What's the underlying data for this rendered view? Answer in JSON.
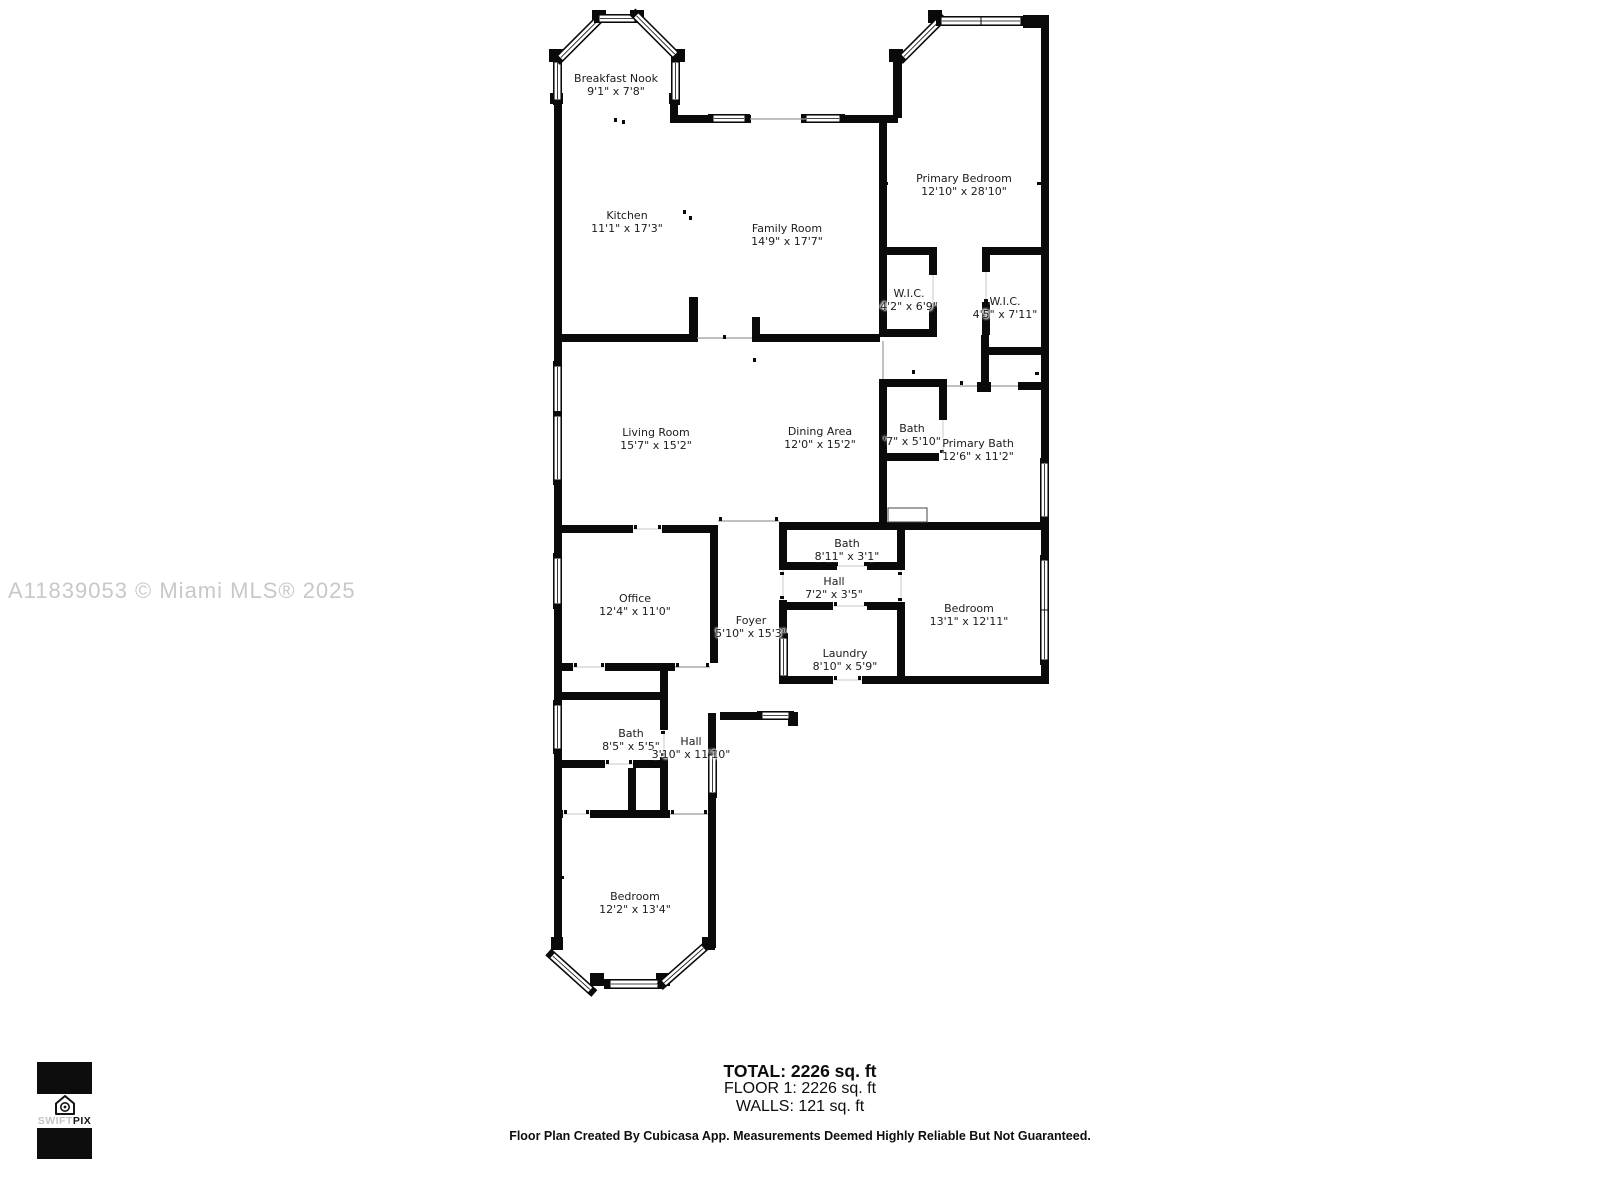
{
  "watermark": "A11839053 © Miami MLS® 2025",
  "logo": {
    "brand_light": "SWIFT",
    "brand_dark": "PIX"
  },
  "rooms": [
    {
      "name": "Breakfast Nook",
      "dims": "9'1\" x 7'8\""
    },
    {
      "name": "Kitchen",
      "dims": "11'1\" x 17'3\""
    },
    {
      "name": "Family Room",
      "dims": "14'9\" x 17'7\""
    },
    {
      "name": "Primary Bedroom",
      "dims": "12'10\" x 28'10\""
    },
    {
      "name": "W.I.C.",
      "dims": "4'2\" x 6'9\""
    },
    {
      "name": "W.I.C.",
      "dims": "4'5\" x 7'11\""
    },
    {
      "name": "Living Room",
      "dims": "15'7\" x 15'2\""
    },
    {
      "name": "Dining Area",
      "dims": "12'0\" x 15'2\""
    },
    {
      "name": "Bath",
      "dims": "'7\" x 5'10\""
    },
    {
      "name": "Primary Bath",
      "dims": "12'6\" x 11'2\""
    },
    {
      "name": "Bath",
      "dims": "8'11\" x 3'1\""
    },
    {
      "name": "Hall",
      "dims": "7'2\" x 3'5\""
    },
    {
      "name": "Bedroom",
      "dims": "13'1\" x 12'11\""
    },
    {
      "name": "Office",
      "dims": "12'4\" x 11'0\""
    },
    {
      "name": "Foyer",
      "dims": "5'10\" x 15'3\""
    },
    {
      "name": "Laundry",
      "dims": "8'10\" x 5'9\""
    },
    {
      "name": "Bath",
      "dims": "8'5\" x 5'5\""
    },
    {
      "name": "Hall",
      "dims": "3'10\" x 11'10\""
    },
    {
      "name": "Bedroom",
      "dims": "12'2\" x 13'4\""
    }
  ],
  "summary": {
    "total": "TOTAL: 2226 sq. ft",
    "floor": "FLOOR 1: 2226 sq. ft",
    "walls": "WALLS: 121 sq. ft"
  },
  "disclaimer": "Floor Plan Created By Cubicasa App. Measurements Deemed Highly Reliable But Not Guaranteed."
}
